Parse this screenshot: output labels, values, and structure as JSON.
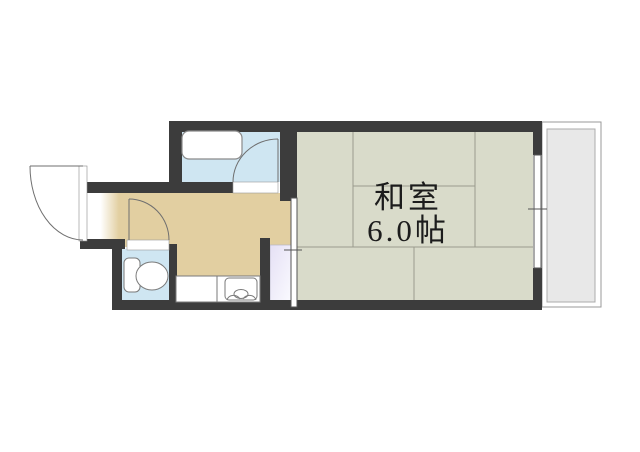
{
  "plan": {
    "type": "apartment-floor-plan",
    "tatami_room": {
      "name": "和室",
      "size": "6.0帖"
    },
    "palette": {
      "wall": "#3c3c3c",
      "tatami_floor": "#d9dbca",
      "hall_kitchen_floor": "#e2cfa1",
      "wet_area_floor": "#cfe6f2",
      "balcony": "#e8e8e8",
      "closet": "#e5e0f5",
      "tatami_line": "#9b9b8d",
      "door_line": "#6f6f6f"
    },
    "fixtures": {
      "bathtub": "bathtub",
      "toilet": "toilet",
      "kitchen_sink": "kitchen-sink",
      "entrance_door": "swing-door",
      "bathroom_door": "swing-door",
      "toilet_door": "swing-door",
      "tatami_entry": "sliding-door",
      "balcony_window": "sliding-window"
    }
  }
}
